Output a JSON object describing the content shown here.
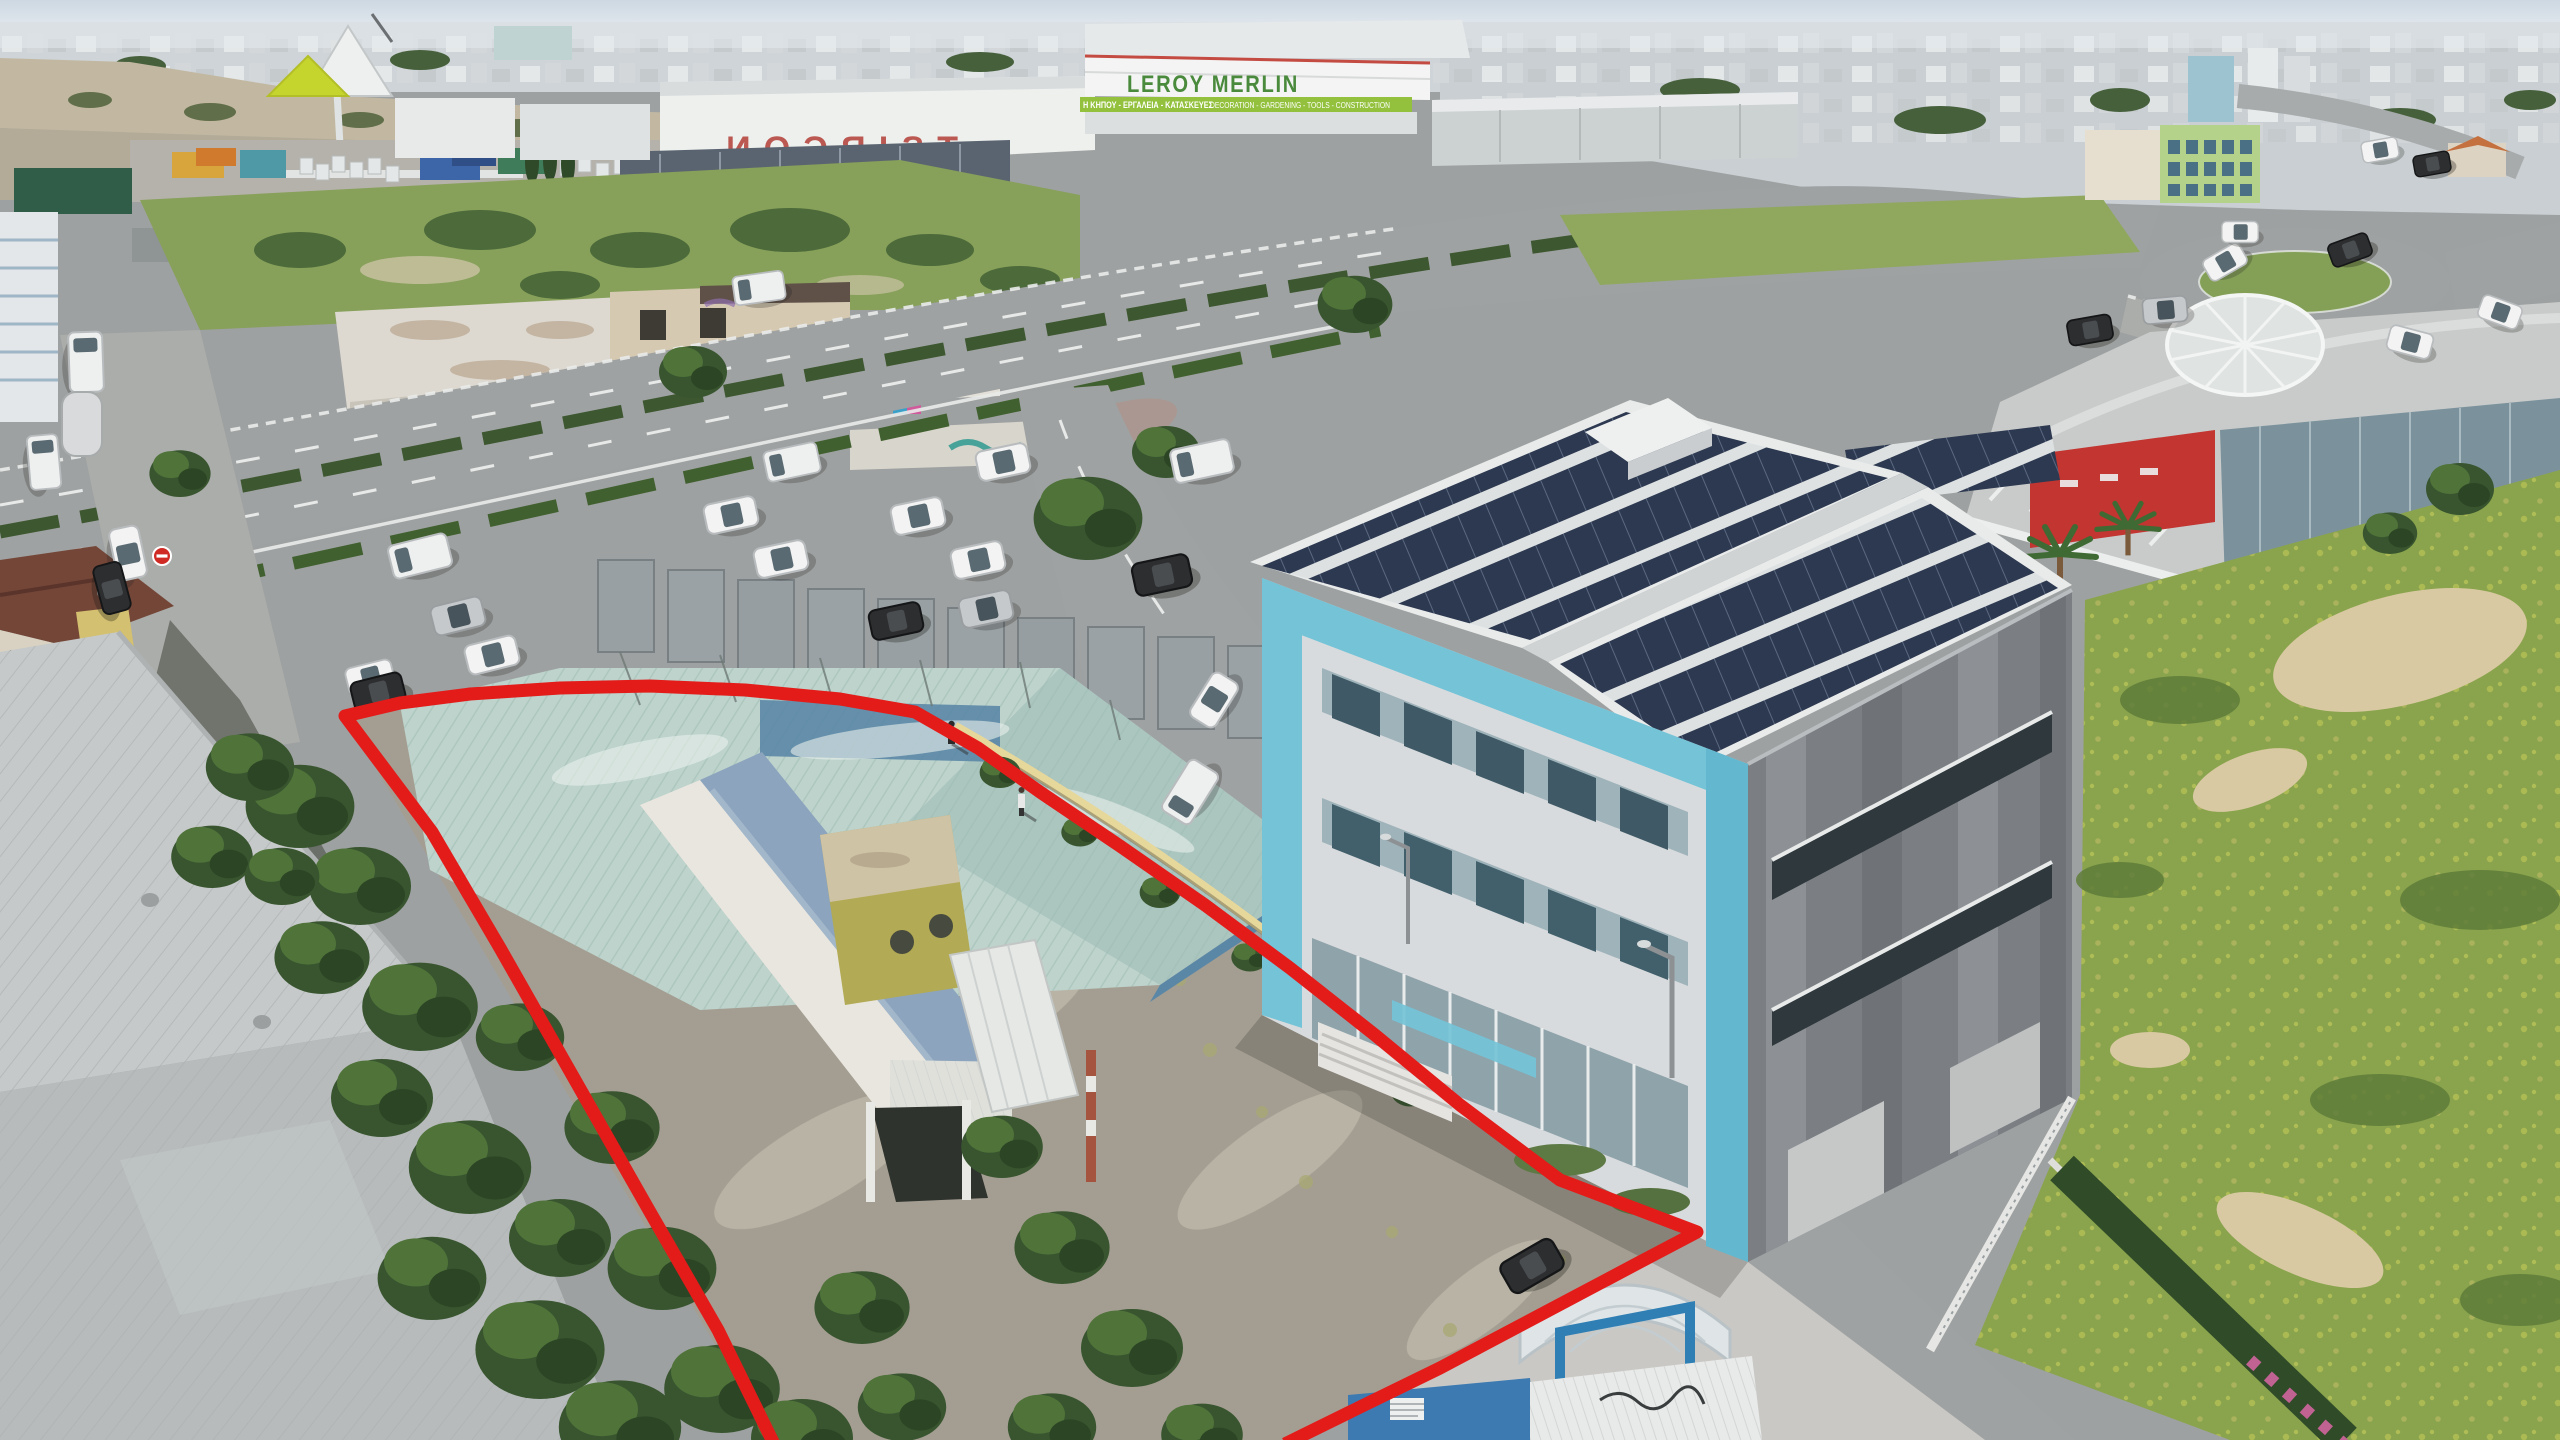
{
  "image_type": "aerial-drone-photograph",
  "location_character": "industrial-commercial district with outlined land parcel",
  "signs": {
    "tsircon_rooftop": "TSIRCON",
    "leroy_merlin_rooftop": "LEROY MERLIN",
    "leroy_merlin_banner_left": "Η ΚΗΠΟΥ - ΕΡΓΑΛΕΙΑ - ΚΑΤΑΣΚΕΥΕΣ",
    "leroy_merlin_banner_right": "DECORATION - GARDENING - TOOLS - CONSTRUCTION"
  },
  "boundary": {
    "label": "red property boundary outline",
    "color": "#e31c1a",
    "stroke_width": 13,
    "points_svg": "775,1446 718,1330 650,1212 575,1080 500,948 432,832 345,716 400,703 470,694 560,688 650,686 745,690 840,699 915,712 978,748 1040,792 1120,846 1205,905 1290,968 1375,1035 1460,1105 1560,1180 1697,1232 1640,1262 1540,1315 1440,1368 1350,1412 1285,1444"
  },
  "palette": {
    "sky_top": "#cdd8e2",
    "sky_horizon": "#eef1f4",
    "red_boundary": "#e31c1a",
    "teal_accent": "#74c3d7",
    "solar_panel": "#2d3950",
    "canopy_roof": "#bdd3cc",
    "leroy_green": "#93c13e",
    "leroy_text_green": "#4a8a3c",
    "tsircon_red": "#b5443c",
    "field_green": "#8aa44d",
    "road_gray": "#9fa2a2"
  }
}
